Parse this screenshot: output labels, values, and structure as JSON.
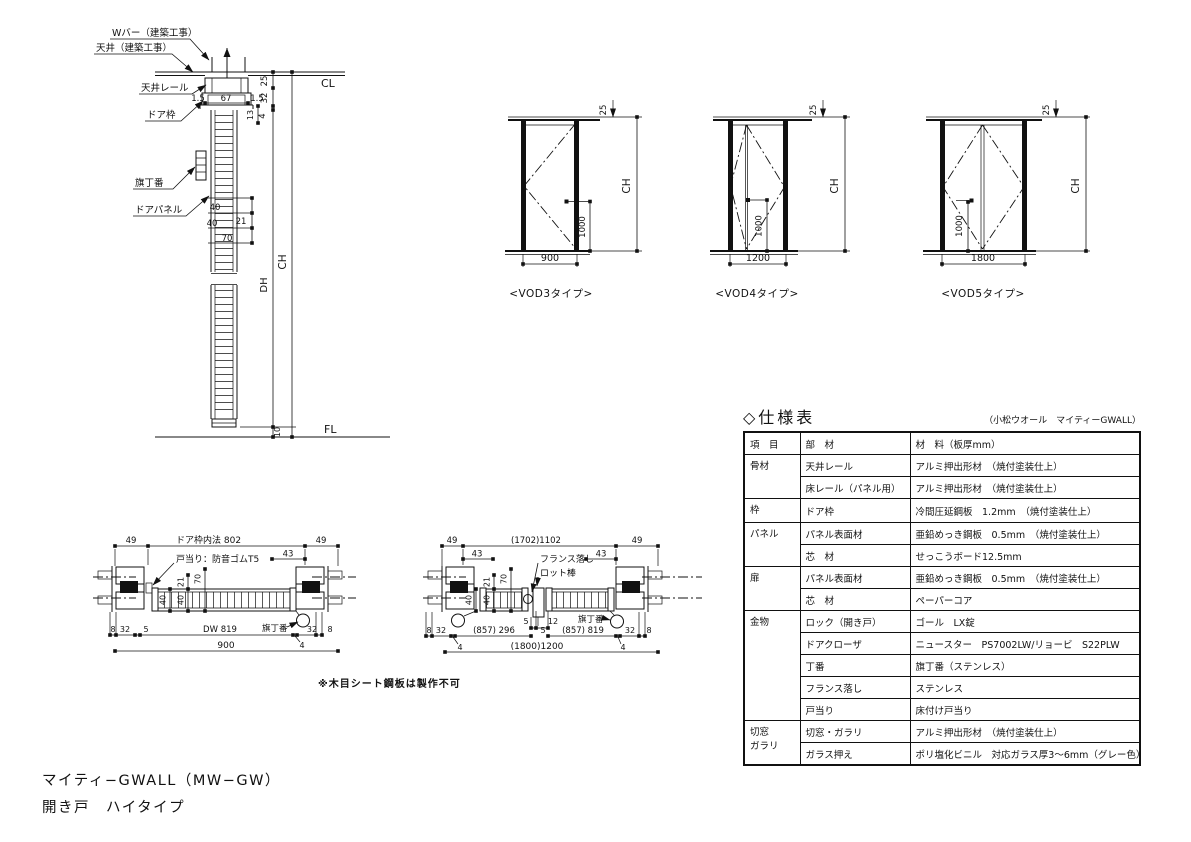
{
  "drawing": {
    "footer": {
      "line1": "マイティ−GWALL（MW−GW）",
      "line2": "開き戸　ハイタイプ"
    },
    "note": "※木目シート鋼板は製作不可"
  },
  "vertical_section": {
    "labels": {
      "w_bar": "Wバー（建築工事）",
      "ceiling": "天井（建築工事）",
      "ceiling_rail": "天井レール",
      "door_frame": "ドア枠",
      "hinge": "旗丁番",
      "door_panel": "ドアパネル",
      "cl": "CL",
      "fl": "FL",
      "ch": "CH",
      "dh": "DH"
    },
    "dims": {
      "rail_left": "1.5",
      "rail_width": "67",
      "rail_right": "1.5",
      "d25": "25",
      "d32": "32",
      "d4": "4",
      "d13": "13",
      "d40a": "40",
      "d40b": "40",
      "d21": "21",
      "d70": "70",
      "floor_gap": "10"
    }
  },
  "elevations": [
    {
      "name": "<VOD3タイプ>",
      "width": "900",
      "handle_height": "1000",
      "top_offset": "25",
      "height_label": "CH"
    },
    {
      "name": "<VOD4タイプ>",
      "width": "1200",
      "handle_height": "1000",
      "top_offset": "25",
      "height_label": "CH"
    },
    {
      "name": "<VOD5タイプ>",
      "width": "1800",
      "handle_height": "1000",
      "top_offset": "25",
      "height_label": "CH"
    }
  ],
  "plan_single": {
    "labels": {
      "frame_inner": "ドア枠内法 802",
      "door_stop": "戸当り：防音ゴムT5",
      "hinge": "旗丁番"
    },
    "dims": {
      "left49": "49",
      "right49": "49",
      "d43": "43",
      "d21": "21",
      "d70": "70",
      "d40a": "40",
      "d40b": "40",
      "b8l": "8",
      "b32l": "32",
      "b5": "5",
      "dw": "DW 819",
      "b4": "4",
      "b32r": "32",
      "b8r": "8",
      "total": "900"
    }
  },
  "plan_double": {
    "labels": {
      "french_bolt": "フランス落し",
      "rod": "ロット棒",
      "hinge": "旗丁番"
    },
    "dims": {
      "left49": "49",
      "inner": "(1702)1102",
      "right49": "49",
      "d43l": "43",
      "d43r": "43",
      "d21": "21",
      "d70": "70",
      "d40a": "40",
      "d40b": "40",
      "b8l": "8",
      "b32l": "32",
      "b4l": "4",
      "leaf1": "(857) 296",
      "c5a": "5",
      "c12": "12",
      "c5b": "5",
      "leaf2": "(857) 819",
      "b4r": "4",
      "b32r": "32",
      "b8r": "8",
      "total": "(1800)1200"
    }
  },
  "spec_table": {
    "title": "◇仕様表",
    "subtitle": "（小松ウオール　マイティーGWALL）",
    "headers": {
      "item": "項　目",
      "part": "部　材",
      "material": "材　料（板厚mm）"
    },
    "groups": {
      "g1": "骨材",
      "g2": "枠",
      "g3": "パネル",
      "g4": "扉",
      "g5": "金物",
      "g6a": "切窓",
      "g6b": "ガラリ"
    },
    "rows": [
      {
        "part": "天井レール",
        "material": "アルミ押出形材　（焼付塗装仕上）"
      },
      {
        "part": "床レール（パネル用）",
        "material": "アルミ押出形材　（焼付塗装仕上）"
      },
      {
        "part": "ドア枠",
        "material": "冷間圧延鋼板　1.2mm　（焼付塗装仕上）"
      },
      {
        "part": "パネル表面材",
        "material": "亜鉛めっき鋼板　0.5mm　（焼付塗装仕上）"
      },
      {
        "part": "芯　材",
        "material": "せっこうボード12.5mm"
      },
      {
        "part": "パネル表面材",
        "material": "亜鉛めっき鋼板　0.5mm　（焼付塗装仕上）"
      },
      {
        "part": "芯　材",
        "material": "ペーパーコア"
      },
      {
        "part": "ロック（開き戸）",
        "material": "ゴール　LX錠"
      },
      {
        "part": "ドアクローザ",
        "material": "ニュースター　PS7002LW/リョービ　S22PLW"
      },
      {
        "part": "丁番",
        "material": "旗丁番（ステンレス）"
      },
      {
        "part": "フランス落し",
        "material": "ステンレス"
      },
      {
        "part": "戸当り",
        "material": "床付け戸当り"
      },
      {
        "part": "切窓・ガラリ",
        "material": "アルミ押出形材　（焼付塗装仕上）"
      },
      {
        "part": "ガラス押え",
        "material": "ポリ塩化ビニル　対応ガラス厚3〜6mm（グレー色）"
      }
    ]
  }
}
